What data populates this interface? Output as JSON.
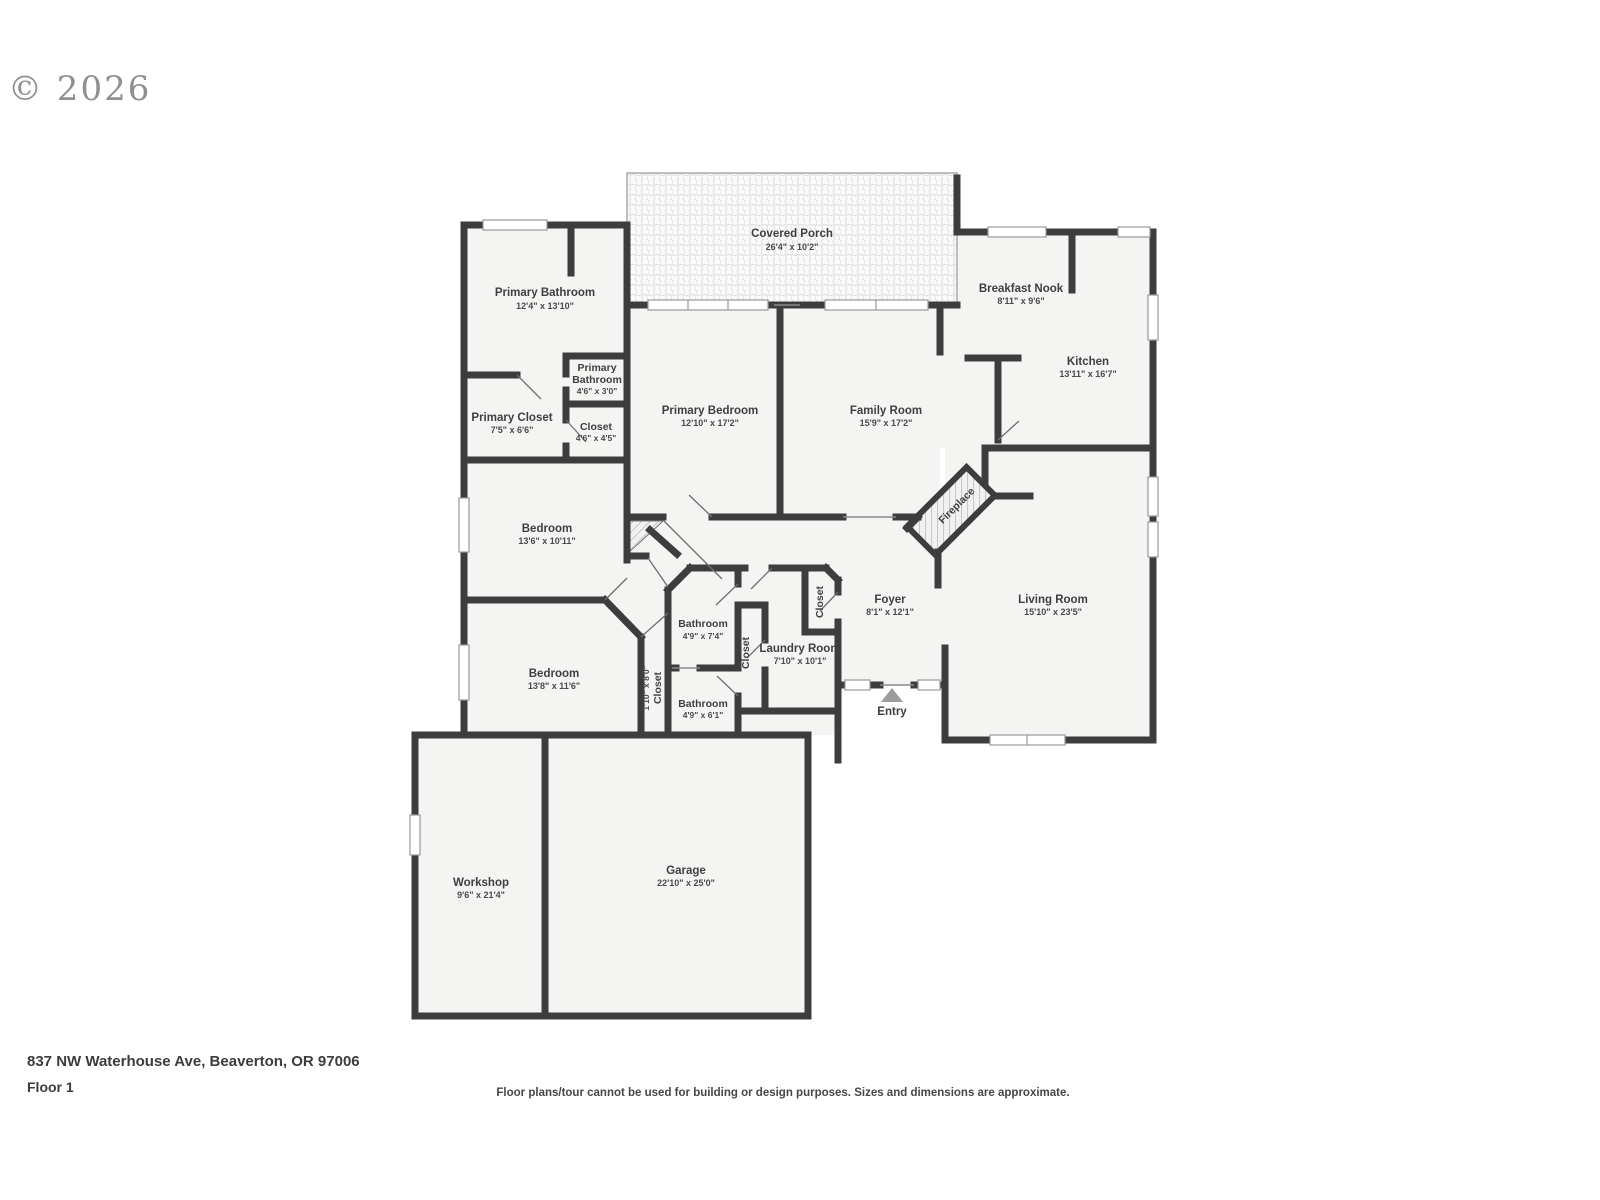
{
  "header": {
    "copyright": "© 2026"
  },
  "rooms": {
    "covered_porch": {
      "name": "Covered Porch",
      "dims": "26'4\" x 10'2\""
    },
    "primary_bathroom": {
      "name": "Primary Bathroom",
      "dims": "12'4\" x 13'10\""
    },
    "primary_bathroom_small": {
      "line1": "Primary",
      "line2": "Bathroom",
      "dims": "4'6\" x 3'0\""
    },
    "primary_closet": {
      "name": "Primary Closet",
      "dims": "7'5\" x 6'6\""
    },
    "closet_small": {
      "name": "Closet",
      "dims": "4'6\" x 4'5\""
    },
    "primary_bedroom": {
      "name": "Primary Bedroom",
      "dims": "12'10\" x 17'2\""
    },
    "family_room": {
      "name": "Family Room",
      "dims": "15'9\" x 17'2\""
    },
    "breakfast_nook": {
      "name": "Breakfast Nook",
      "dims": "8'11\" x 9'6\""
    },
    "kitchen": {
      "name": "Kitchen",
      "dims": "13'11\" x 16'7\""
    },
    "bedroom_upper": {
      "name": "Bedroom",
      "dims": "13'6\" x 10'11\""
    },
    "bedroom_lower": {
      "name": "Bedroom",
      "dims": "13'8\" x 11'6\""
    },
    "bathroom_upper": {
      "name": "Bathroom",
      "dims": "4'9\" x 7'4\""
    },
    "bathroom_lower": {
      "name": "Bathroom",
      "dims": "4'9\" x 6'1\""
    },
    "laundry_room": {
      "name": "Laundry Room",
      "dims": "7'10\" x 10'1\""
    },
    "closet_hall": {
      "name": "Closet"
    },
    "closet_foyer": {
      "name": "Closet"
    },
    "closet_narrow": {
      "name": "Closet",
      "dims": "1'10\" x 8'0\""
    },
    "foyer": {
      "name": "Foyer",
      "dims": "8'1\" x 12'1\""
    },
    "living_room": {
      "name": "Living Room",
      "dims": "15'10\" x 23'5\""
    },
    "workshop": {
      "name": "Workshop",
      "dims": "9'6\" x 21'4\""
    },
    "garage": {
      "name": "Garage",
      "dims": "22'10\" x 25'0\""
    },
    "fireplace": {
      "name": "Fireplace"
    },
    "entry": {
      "name": "Entry"
    }
  },
  "footer": {
    "address": "837 NW Waterhouse Ave, Beaverton, OR 97006",
    "floor": "Floor 1",
    "disclaimer": "Floor plans/tour cannot be used for building or design purposes. Sizes and dimensions are approximate."
  },
  "colors": {
    "wall": "#3d3d3d",
    "floor": "#f4f4f3",
    "label": "#3f3f3f",
    "copyright": "#8f8f8f"
  }
}
